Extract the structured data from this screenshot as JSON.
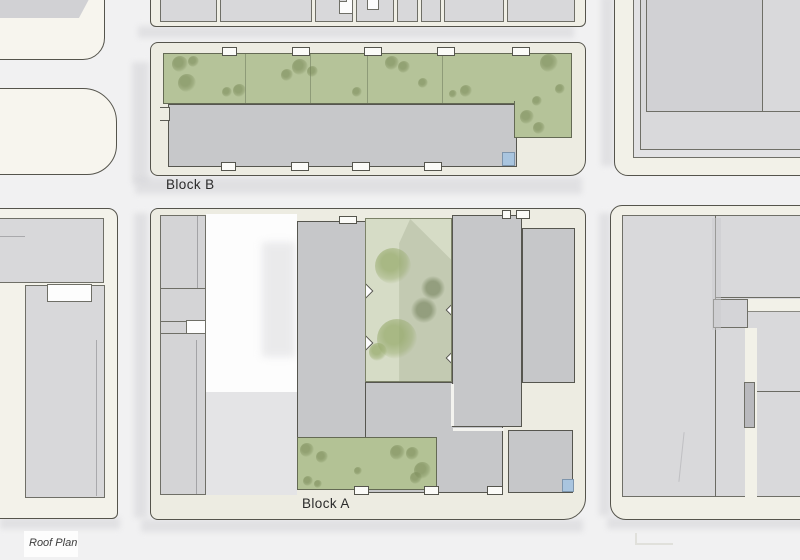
{
  "title_block": {
    "title": "Roof Plan"
  },
  "plan": {
    "block_a_label": "Block A",
    "block_b_label": "Block B"
  },
  "colors": {
    "street_bg": "#f1f1f2",
    "sidewalk": "#edece2",
    "context_site": "#f3f2ea",
    "context_building": "#d8d8da",
    "new_roof_gray": "#c6c7c9",
    "green_roof": "#b5c399",
    "courtyard_green": "#d6dcc6",
    "skylight_blue": "#a9c5df",
    "outline": "#55544c"
  },
  "trees": {
    "groups": [
      {
        "tone": "olive",
        "items": [
          [
            180,
            64,
            16
          ],
          [
            193,
            61,
            11
          ],
          [
            187,
            83,
            18
          ],
          [
            227,
            92,
            10
          ],
          [
            239,
            90,
            13
          ],
          [
            287,
            75,
            12
          ],
          [
            300,
            67,
            16
          ],
          [
            312,
            71,
            11
          ],
          [
            357,
            92,
            10
          ],
          [
            392,
            63,
            14
          ],
          [
            404,
            67,
            12
          ],
          [
            423,
            83,
            10
          ],
          [
            453,
            94,
            8
          ],
          [
            466,
            91,
            12
          ],
          [
            549,
            63,
            18
          ],
          [
            560,
            89,
            10
          ],
          [
            537,
            101,
            10
          ],
          [
            527,
            117,
            14
          ],
          [
            539,
            128,
            12
          ],
          [
            307,
            450,
            14
          ],
          [
            322,
            457,
            12
          ],
          [
            308,
            481,
            10
          ],
          [
            318,
            484,
            8
          ],
          [
            358,
            471,
            8
          ],
          [
            397,
            452,
            15
          ],
          [
            412,
            453,
            13
          ],
          [
            422,
            470,
            17
          ],
          [
            416,
            478,
            12
          ]
        ]
      },
      {
        "tone": "fluffy",
        "items": [
          [
            393,
            266,
            36
          ],
          [
            397,
            339,
            40
          ],
          [
            378,
            352,
            18
          ]
        ]
      },
      {
        "tone": "shade",
        "items": [
          [
            433,
            288,
            24
          ],
          [
            424,
            310,
            26
          ]
        ]
      }
    ]
  }
}
